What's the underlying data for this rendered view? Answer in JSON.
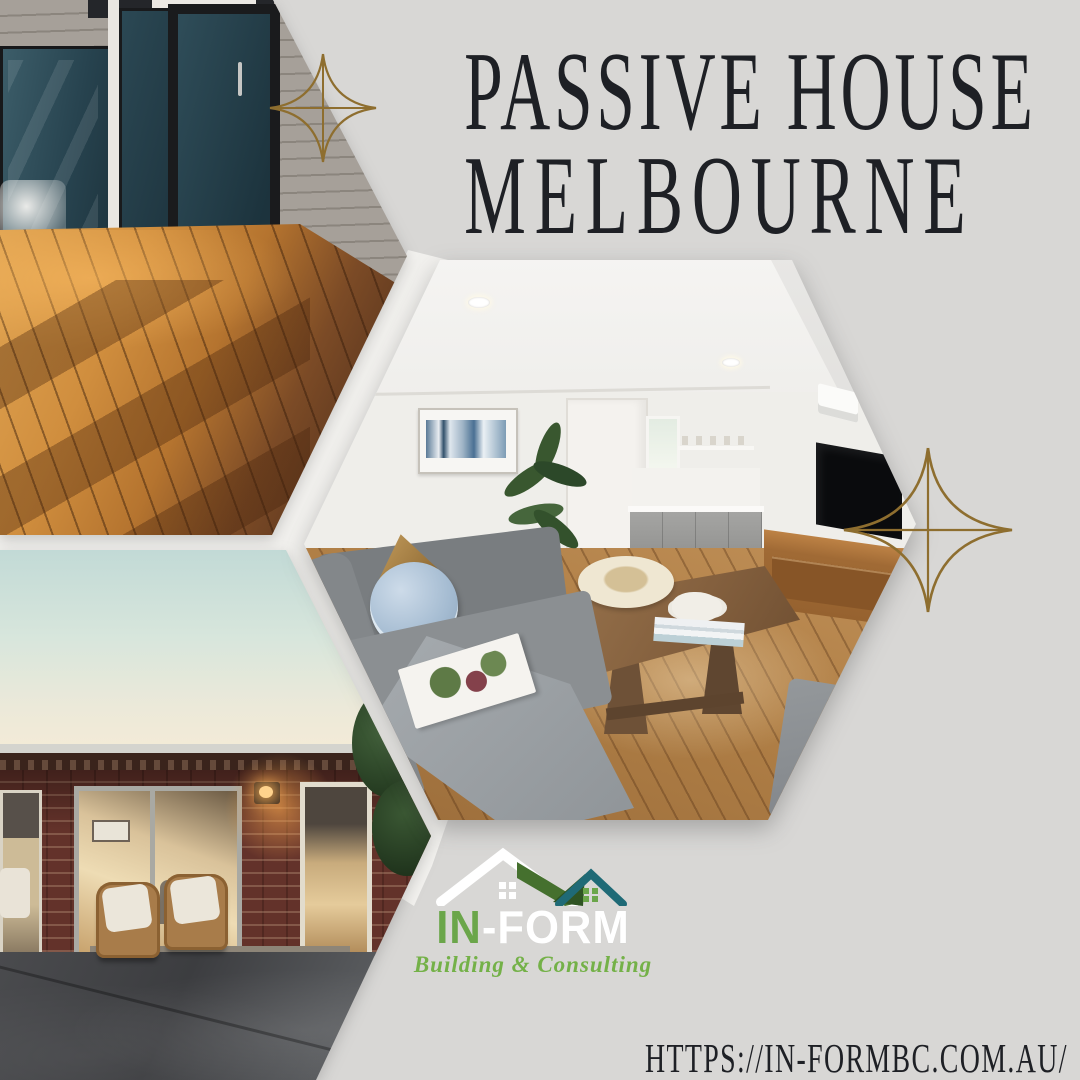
{
  "poster": {
    "title": {
      "line1": "PASSIVE HOUSE",
      "line2": "MELBOURNE"
    },
    "website_url": "HTTPS://IN-FORMBC.COM.AU/",
    "logo": {
      "brand_green": "IN",
      "brand_rest": "-FORM",
      "tagline": "Building & Consulting"
    },
    "colors": {
      "background": "#d8d7d5",
      "gap_white": "#f2f1ee",
      "title_text": "#1e2025",
      "sparkle_gold": "#8e6e2f",
      "logo_green": "#6ba64a",
      "logo_dark_green": "#45702e",
      "logo_teal": "#1f6a76",
      "logo_white": "#ffffff"
    },
    "photos": {
      "top_left": "sunlit-timber-deck-with-glass-doors",
      "center_right": "open-plan-living-room-interior",
      "bottom_left": "brick-house-exterior-at-dusk"
    }
  }
}
